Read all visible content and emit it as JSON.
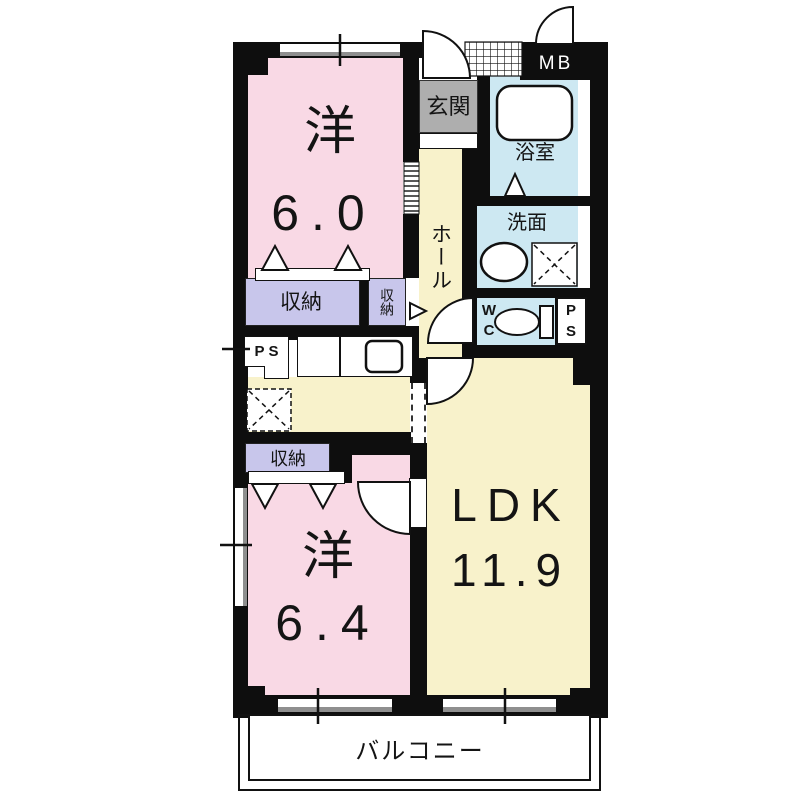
{
  "colors": {
    "pink": "#f9d9e5",
    "yellow": "#f8f2cb",
    "blue": "#cde8f2",
    "lavender": "#c8c6eb",
    "gray": "#aeaeae",
    "wall": "#0e0e0e",
    "window_gray": "#8f8f8f"
  },
  "rooms": {
    "western1": {
      "name": "洋",
      "area": "6.0"
    },
    "western2": {
      "name": "洋",
      "area": "6.4"
    },
    "ldk": {
      "name": "LDK",
      "area": "11.9"
    },
    "hall": {
      "name": "ホール"
    },
    "entrance": {
      "name": "玄関"
    },
    "bath": {
      "name": "浴室"
    },
    "washroom": {
      "name": "洗面"
    },
    "wc": {
      "letters": [
        "W",
        "C"
      ]
    },
    "meterbox": {
      "name": "MB"
    },
    "pipespace_left": {
      "name": "PS"
    },
    "pipespace_right": {
      "letters": [
        "P",
        "S"
      ]
    },
    "storage_upper_left": {
      "name": "収納"
    },
    "storage_upper_right": {
      "name": "収納"
    },
    "storage_lower": {
      "name": "収納"
    },
    "balcony": {
      "name": "バルコニー"
    }
  }
}
